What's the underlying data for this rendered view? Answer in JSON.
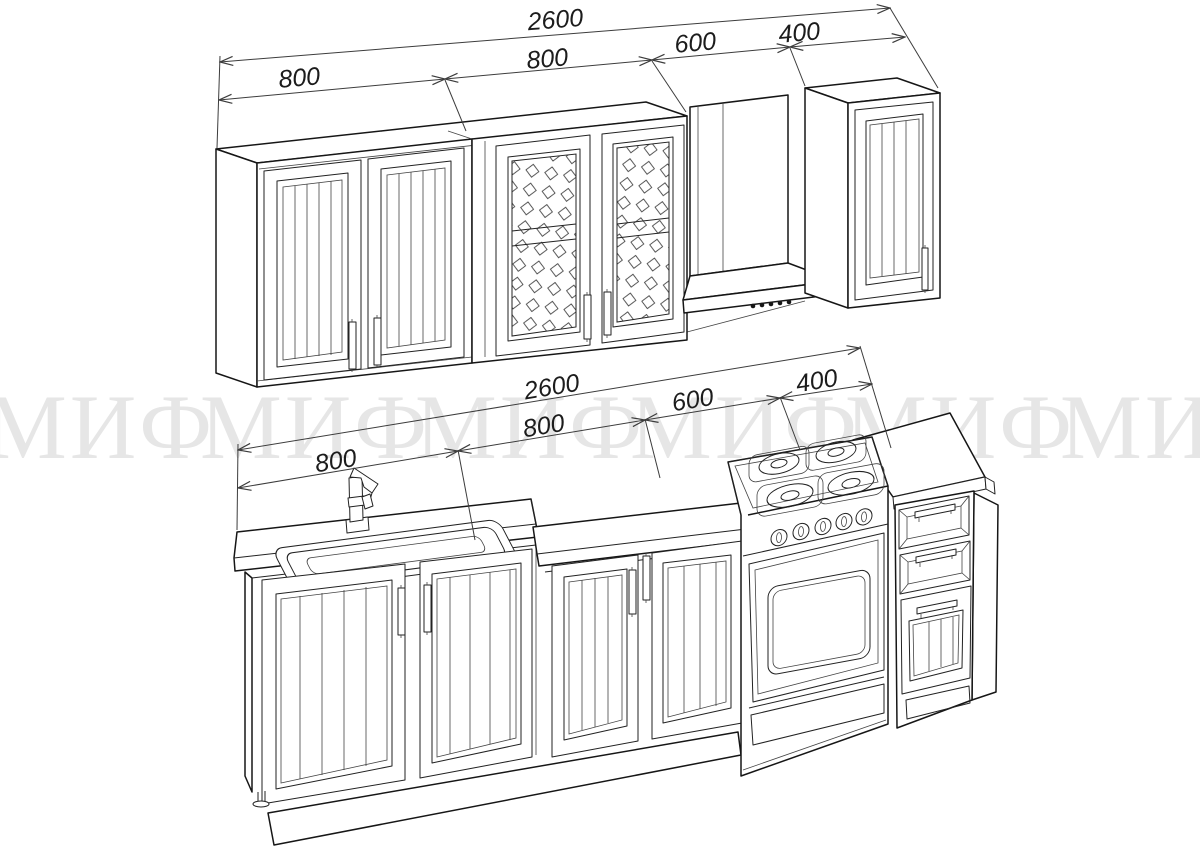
{
  "watermark": {
    "text": "МИФ"
  },
  "dimensions": {
    "top": {
      "overall": "2600",
      "seg1": "800",
      "seg2": "800",
      "seg3": "600",
      "seg4": "400"
    },
    "bottom": {
      "overall": "2600",
      "seg1": "800",
      "seg2": "800",
      "seg3": "600",
      "seg4": "400"
    }
  },
  "colors": {
    "background": "#ffffff",
    "line": "#161616",
    "dimension_line": "#3c3c3c",
    "watermark": "#e6e6e6"
  }
}
